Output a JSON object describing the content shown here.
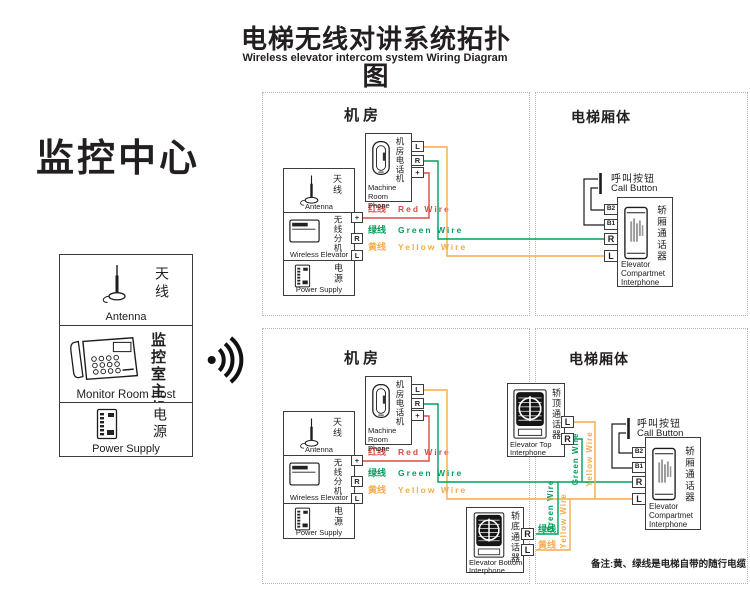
{
  "header": {
    "title_zh": "电梯无线对讲系统拓扑图",
    "title_en": "Wireless elevator intercom system Wiring Diagram"
  },
  "monitor_center": {
    "title": "监控中心",
    "antenna_zh": "天线",
    "antenna_en": "Antenna",
    "host_zh": "监控室主机",
    "host_en": "Monitor Room Host",
    "power_zh": "电源",
    "power_en": "Power Supply"
  },
  "sections": {
    "machine_room": "机房",
    "elevator_car": "电梯厢体"
  },
  "devices": {
    "machine_phone_zh": "机房电话机",
    "machine_phone_en1": "Machine",
    "machine_phone_en2": "Room Phone",
    "antenna_zh": "天线",
    "antenna_en": "Antenna",
    "wireless_zh": "无线分机",
    "wireless_en": "Wireless Elevator",
    "power_zh": "电源",
    "power_en": "Power Supply",
    "call_button_zh": "呼叫按钮",
    "call_button_en": "Call Button",
    "compartment_zh": "轿厢通话器",
    "compartment_en1": "Elevator",
    "compartment_en2": "Compartmet",
    "compartment_en3": "Interphone",
    "top_interphone_zh": "轿顶通话器",
    "top_interphone_en1": "Elevator Top",
    "top_interphone_en2": "Interphone",
    "bottom_interphone_zh": "轿底通话器",
    "bottom_interphone_en1": "Elevator Bottom",
    "bottom_interphone_en2": "Interphone"
  },
  "wires": {
    "red_zh": "红线",
    "red_en": "Red Wire",
    "green_zh": "绿线",
    "green_en": "Green Wire",
    "yellow_zh": "黄线",
    "yellow_en": "Yellow Wire"
  },
  "terminals": {
    "l": "L",
    "r": "R",
    "plus": "+",
    "b1": "B1",
    "b2": "B2"
  },
  "note": "备注:黄、绿线是电梯自带的随行电缆",
  "colors": {
    "red_wire": "#dd4a43",
    "green_wire": "#00a05c",
    "yellow_wire": "#f5ab4a",
    "ink": "#231f20"
  }
}
